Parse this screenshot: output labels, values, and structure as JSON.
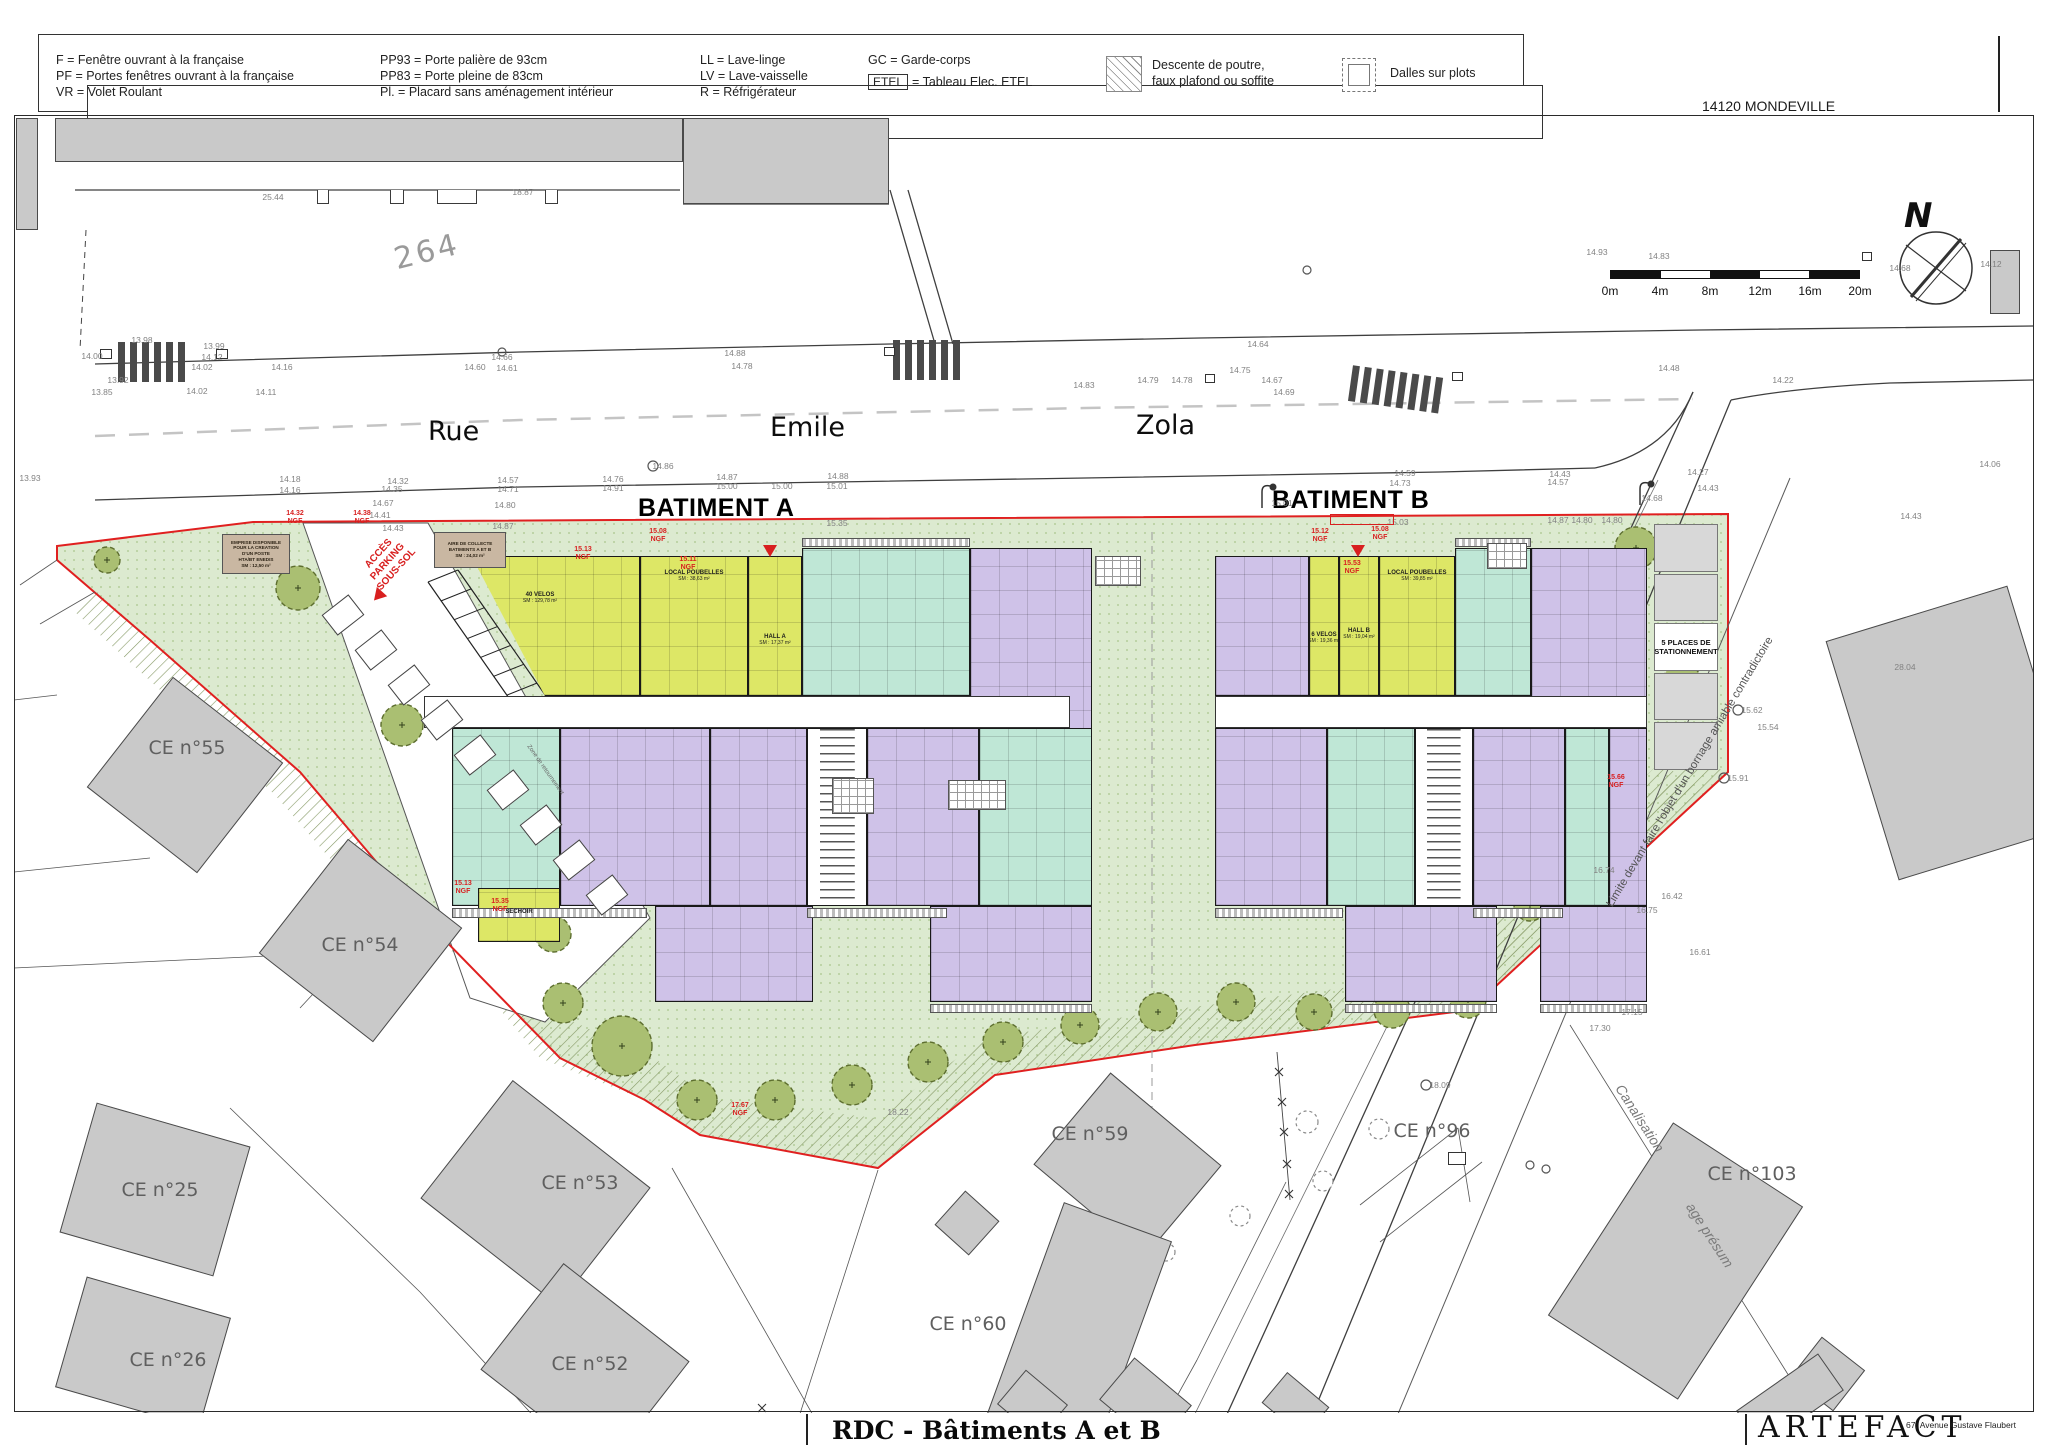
{
  "colors": {
    "green": "#dcead0",
    "green_dot": "#a9c48b",
    "hatch": "#879a66",
    "chartreuse": "#dde766",
    "mint": "#bfe7d6",
    "purple": "#cfc2e8",
    "brown": "#c9b7a2",
    "gray_building": "#c9c9c9",
    "red": "#d81f1f",
    "road_line": "#3f3f3f",
    "blue": "#5b79c9"
  },
  "legend": {
    "col1": [
      "F = Fenêtre ouvrant à la française",
      "PF = Portes fenêtres ouvrant à la française",
      "VR = Volet Roulant"
    ],
    "col2": [
      "PP93 = Porte palière de 93cm",
      "PP83 = Porte pleine de 83cm",
      "Pl. = Placard sans aménagement intérieur"
    ],
    "col3": [
      "LL = Lave-linge",
      "LV = Lave-vaisselle",
      "R = Réfrigérateur"
    ],
    "gc_line": "GC = Garde-corps",
    "etel_box": "ETEL",
    "etel_rest": "= Tableau Elec. ETEL",
    "hatch_line1": "Descente de poutre,",
    "hatch_line2": "faux plafond ou soffite",
    "plots_label": "Dalles sur plots"
  },
  "sheet": {
    "location": "14120 MONDEVILLE",
    "parcel_number": "264",
    "north": "N"
  },
  "scale_bar": {
    "labels": [
      "0m",
      "4m",
      "8m",
      "12m",
      "16m",
      "20m"
    ]
  },
  "streets": [
    {
      "t": "Rue",
      "x": 428,
      "y": 416
    },
    {
      "t": "Emile",
      "x": 770,
      "y": 412
    },
    {
      "t": "Zola",
      "x": 1136,
      "y": 410
    }
  ],
  "buildings": [
    {
      "t": "BATIMENT A",
      "x": 638,
      "y": 494
    },
    {
      "t": "BATIMENT B",
      "x": 1272,
      "y": 486
    }
  ],
  "parcels": [
    {
      "t": "CE n°55",
      "x": 187,
      "y": 748
    },
    {
      "t": "CE n°54",
      "x": 360,
      "y": 945
    },
    {
      "t": "CE n°25",
      "x": 160,
      "y": 1190
    },
    {
      "t": "CE n°26",
      "x": 168,
      "y": 1360
    },
    {
      "t": "CE n°53",
      "x": 580,
      "y": 1183
    },
    {
      "t": "CE n°52",
      "x": 590,
      "y": 1364
    },
    {
      "t": "CE n°59",
      "x": 1090,
      "y": 1134
    },
    {
      "t": "CE n°60",
      "x": 968,
      "y": 1324
    },
    {
      "t": "CE n°96",
      "x": 1432,
      "y": 1131
    },
    {
      "t": "CE n°103",
      "x": 1752,
      "y": 1174
    }
  ],
  "rooms": [
    {
      "t": "40 VELOS",
      "s": "SM : 129,78 m²",
      "x": 540,
      "y": 598
    },
    {
      "t": "LOCAL POUBELLES",
      "s": "SM : 38,63 m²",
      "x": 694,
      "y": 576
    },
    {
      "t": "HALL A",
      "s": "SM : 17,37 m²",
      "x": 775,
      "y": 640
    },
    {
      "t": "6 VELOS",
      "s": "SM : 19,36 m²",
      "x": 1324,
      "y": 638
    },
    {
      "t": "HALL B",
      "s": "SM : 19,04 m²",
      "x": 1359,
      "y": 634
    },
    {
      "t": "LOCAL POUBELLES",
      "s": "SM : 39,85 m²",
      "x": 1417,
      "y": 576
    },
    {
      "t": "SECHOIR",
      "s": "",
      "x": 519,
      "y": 912
    }
  ],
  "annotations": {
    "access": [
      "ACCÈS",
      "PARKING",
      "SOUS-SOL"
    ],
    "limit": "Limite devant faire l'objet d'un bornage amiable contradictoire",
    "canal1": "Canalisation",
    "canal2": "age présum",
    "turnzone": "Zone de retournement",
    "parking5_l1": "5 PLACES DE",
    "parking5_l2": "STATIONNEMENT"
  },
  "brown_boxes": [
    {
      "lines": [
        "EMPRISE DISPONIBLE",
        "POUR LA CREATION",
        "D'UN POSTE",
        "HTA/BT ENEDIS",
        "SM : 12,50 m²"
      ],
      "x": 222,
      "y": 534,
      "w": 68,
      "h": 40
    },
    {
      "lines": [
        "AIRE DE COLLECTE",
        "BATIMENTS A ET B",
        "SM : 24,02 m²"
      ],
      "x": 434,
      "y": 532,
      "w": 72,
      "h": 36
    }
  ],
  "elevations": [
    [
      "13.93",
      30,
      478
    ],
    [
      "14.00",
      92,
      356
    ],
    [
      "13.98",
      142,
      340
    ],
    [
      "13.92",
      118,
      380
    ],
    [
      "13.85",
      102,
      392
    ],
    [
      "14.12",
      212,
      357
    ],
    [
      "13.99",
      214,
      346
    ],
    [
      "14.02",
      202,
      367
    ],
    [
      "14.02",
      197,
      391
    ],
    [
      "14.16",
      282,
      367
    ],
    [
      "14.11",
      266,
      392
    ],
    [
      "14.18",
      290,
      479
    ],
    [
      "14.16",
      290,
      490
    ],
    [
      "14.66",
      502,
      357
    ],
    [
      "14.60",
      475,
      367
    ],
    [
      "14.61",
      507,
      368
    ],
    [
      "25.44",
      273,
      197
    ],
    [
      "18.87",
      523,
      192
    ],
    [
      "14.32",
      398,
      481
    ],
    [
      "14.35",
      392,
      489
    ],
    [
      "14.67",
      383,
      503
    ],
    [
      "14.41",
      380,
      515
    ],
    [
      "14.43",
      393,
      528
    ],
    [
      "14.57",
      508,
      480
    ],
    [
      "14.71",
      508,
      489
    ],
    [
      "14.80",
      505,
      505
    ],
    [
      "14.87",
      503,
      526
    ],
    [
      "14.76",
      613,
      479
    ],
    [
      "14.91",
      613,
      488
    ],
    [
      "14.86",
      663,
      466
    ],
    [
      "14.88",
      735,
      353
    ],
    [
      "14.78",
      742,
      366
    ],
    [
      "14.87",
      727,
      477
    ],
    [
      "15.00",
      727,
      486
    ],
    [
      "15.00",
      782,
      486
    ],
    [
      "14.83",
      1084,
      385
    ],
    [
      "14.79",
      1148,
      380
    ],
    [
      "14.78",
      1182,
      380
    ],
    [
      "14.88",
      838,
      476
    ],
    [
      "15.01",
      837,
      486
    ],
    [
      "15.35",
      837,
      523
    ],
    [
      "14.64",
      1258,
      344
    ],
    [
      "14.75",
      1240,
      370
    ],
    [
      "14.67",
      1272,
      380
    ],
    [
      "14.69",
      1284,
      392
    ],
    [
      "14.93",
      1597,
      252
    ],
    [
      "14.83",
      1659,
      256
    ],
    [
      "14.68",
      1900,
      268
    ],
    [
      "14.12",
      1991,
      264
    ],
    [
      "14.48",
      1669,
      368
    ],
    [
      "14.22",
      1783,
      380
    ],
    [
      "14.06",
      1990,
      464
    ],
    [
      "14.43",
      1911,
      516
    ],
    [
      "14.59",
      1405,
      473
    ],
    [
      "14.73",
      1400,
      483
    ],
    [
      "14.43",
      1560,
      474
    ],
    [
      "14.57",
      1558,
      482
    ],
    [
      "14.27",
      1698,
      472
    ],
    [
      "15.01",
      1282,
      503
    ],
    [
      "15.03",
      1398,
      522
    ],
    [
      "14.87",
      1558,
      520
    ],
    [
      "14.80",
      1582,
      520
    ],
    [
      "14.80",
      1612,
      520
    ],
    [
      "14.68",
      1652,
      498
    ],
    [
      "14.43",
      1708,
      488
    ],
    [
      "15.62",
      1752,
      710
    ],
    [
      "15.91",
      1738,
      778
    ],
    [
      "15.54",
      1768,
      727
    ],
    [
      "16.74",
      1604,
      870
    ],
    [
      "16.75",
      1647,
      910
    ],
    [
      "16.42",
      1672,
      896
    ],
    [
      "16.61",
      1700,
      952
    ],
    [
      "17.15",
      1632,
      1012
    ],
    [
      "17.30",
      1600,
      1028
    ],
    [
      "28.04",
      1905,
      667
    ],
    [
      "18.09",
      1440,
      1085
    ],
    [
      "18.22",
      898,
      1112
    ]
  ],
  "ngf": [
    [
      "14.32",
      295,
      510
    ],
    [
      "14.38",
      362,
      510
    ],
    [
      "15.13",
      583,
      546
    ],
    [
      "15.08",
      658,
      528
    ],
    [
      "15.11",
      688,
      556
    ],
    [
      "15.12",
      1320,
      528
    ],
    [
      "15.08",
      1380,
      526
    ],
    [
      "15.53",
      1352,
      560
    ],
    [
      "15.13",
      463,
      880
    ],
    [
      "15.35",
      500,
      898
    ],
    [
      "17.67",
      740,
      1102
    ],
    [
      "15.66",
      1616,
      774
    ]
  ],
  "titleblock": {
    "title": "RDC - Bâtiments A et B",
    "firm": "ARTEFACT",
    "address": "67, Avenue Gustave Flaubert"
  },
  "floorplan": {
    "units": [
      [
        424,
        556,
        216,
        140,
        "ch",
        "polygon(22% 0,100% 0,100% 100%,56% 100%)"
      ],
      [
        640,
        556,
        108,
        140,
        "ch"
      ],
      [
        748,
        556,
        54,
        140,
        "ch"
      ],
      [
        802,
        548,
        168,
        148,
        "mi"
      ],
      [
        970,
        548,
        122,
        212,
        "pu"
      ],
      [
        424,
        696,
        646,
        32,
        "wh"
      ],
      [
        452,
        728,
        108,
        178,
        "mi"
      ],
      [
        560,
        728,
        150,
        178,
        "pu"
      ],
      [
        710,
        728,
        97,
        178,
        "pu"
      ],
      [
        807,
        728,
        60,
        178,
        "st"
      ],
      [
        867,
        728,
        112,
        178,
        "pu"
      ],
      [
        979,
        728,
        113,
        178,
        "mi"
      ],
      [
        655,
        906,
        158,
        96,
        "pu"
      ],
      [
        930,
        906,
        162,
        96,
        "pu"
      ],
      [
        478,
        888,
        82,
        54,
        "ch"
      ],
      [
        1215,
        556,
        94,
        140,
        "pu"
      ],
      [
        1309,
        556,
        30,
        140,
        "ch"
      ],
      [
        1339,
        556,
        40,
        140,
        "ch"
      ],
      [
        1379,
        556,
        76,
        140,
        "ch"
      ],
      [
        1455,
        548,
        76,
        148,
        "mi"
      ],
      [
        1531,
        548,
        116,
        212,
        "pu"
      ],
      [
        1215,
        696,
        432,
        32,
        "wh"
      ],
      [
        1215,
        728,
        112,
        178,
        "pu"
      ],
      [
        1327,
        728,
        88,
        178,
        "mi"
      ],
      [
        1415,
        728,
        58,
        178,
        "st"
      ],
      [
        1473,
        728,
        92,
        178,
        "pu"
      ],
      [
        1565,
        728,
        44,
        178,
        "mi"
      ],
      [
        1609,
        728,
        38,
        178,
        "pu"
      ],
      [
        1345,
        906,
        152,
        96,
        "pu"
      ],
      [
        1540,
        906,
        107,
        96,
        "pu"
      ]
    ],
    "balconies": [
      [
        452,
        908,
        195,
        10
      ],
      [
        807,
        908,
        140,
        10
      ],
      [
        1215,
        908,
        128,
        10
      ],
      [
        1473,
        908,
        90,
        10
      ],
      [
        802,
        538,
        168,
        9
      ],
      [
        1455,
        538,
        76,
        9
      ],
      [
        930,
        1004,
        162,
        9
      ],
      [
        1345,
        1004,
        152,
        9
      ],
      [
        1540,
        1004,
        107,
        9
      ]
    ],
    "pergolas": [
      [
        832,
        778,
        42,
        36
      ],
      [
        948,
        780,
        58,
        30
      ],
      [
        1487,
        543,
        40,
        26
      ],
      [
        1095,
        556,
        46,
        30
      ]
    ],
    "stalls": {
      "x0": 330,
      "y0": 598,
      "dx": 33,
      "dy": 35,
      "n": 9,
      "w": 26,
      "h": 34,
      "rot": 52
    },
    "pstalls": {
      "x": 1654,
      "y": 524,
      "w": 64,
      "h": 248,
      "n": 5,
      "label_cell": 2
    },
    "gray_buildings": [
      [
        16,
        118,
        22,
        112,
        0
      ],
      [
        55,
        118,
        628,
        44,
        0
      ],
      [
        683,
        118,
        206,
        86,
        0
      ],
      [
        1990,
        250,
        30,
        64,
        0
      ],
      [
        115,
        705,
        140,
        140,
        38
      ],
      [
        288,
        868,
        145,
        145,
        38
      ],
      [
        75,
        1122,
        160,
        135,
        16
      ],
      [
        68,
        1295,
        150,
        115,
        16
      ],
      [
        448,
        1118,
        175,
        150,
        38
      ],
      [
        505,
        1298,
        160,
        135,
        38
      ],
      [
        1055,
        1105,
        145,
        120,
        40
      ],
      [
        1022,
        1215,
        115,
        225,
        20
      ],
      [
        944,
        1200,
        46,
        46,
        42
      ],
      [
        1598,
        1146,
        155,
        230,
        33
      ],
      [
        1800,
        1348,
        55,
        52,
        38
      ],
      [
        1858,
        608,
        190,
        250,
        -17
      ],
      [
        1005,
        1382,
        55,
        45,
        40
      ],
      [
        1108,
        1375,
        75,
        55,
        40
      ],
      [
        1268,
        1385,
        55,
        40,
        40
      ],
      [
        1740,
        1378,
        100,
        45,
        -35
      ]
    ],
    "teeth": [
      [
        317,
        190,
        12,
        14
      ],
      [
        390,
        190,
        14,
        14
      ],
      [
        437,
        190,
        40,
        14
      ],
      [
        545,
        190,
        13,
        14
      ]
    ],
    "crosswalks": [
      [
        118,
        342,
        78,
        40,
        0
      ],
      [
        893,
        340,
        74,
        40,
        0
      ],
      [
        1350,
        372,
        100,
        36,
        8
      ]
    ],
    "trees": [
      [
        697,
        1100,
        20
      ],
      [
        775,
        1100,
        20
      ],
      [
        852,
        1085,
        20
      ],
      [
        928,
        1062,
        20
      ],
      [
        1003,
        1042,
        20
      ],
      [
        1080,
        1025,
        19
      ],
      [
        1158,
        1012,
        19
      ],
      [
        1236,
        1002,
        19
      ],
      [
        1314,
        1012,
        18
      ],
      [
        1392,
        1010,
        18
      ],
      [
        1468,
        1000,
        18
      ],
      [
        1530,
        905,
        16
      ],
      [
        1576,
        866,
        15
      ],
      [
        1608,
        807,
        17
      ],
      [
        1682,
        682,
        19
      ],
      [
        1636,
        548,
        21
      ],
      [
        622,
        1046,
        30
      ],
      [
        563,
        1003,
        20
      ],
      [
        553,
        934,
        18
      ],
      [
        486,
        834,
        21
      ],
      [
        402,
        725,
        21
      ],
      [
        298,
        588,
        22
      ],
      [
        107,
        560,
        13
      ]
    ],
    "bushes": [
      [
        1307,
        1122,
        11
      ],
      [
        1379,
        1129,
        10
      ],
      [
        1323,
        1181,
        10
      ],
      [
        1240,
        1216,
        10
      ],
      [
        1166,
        1252,
        9
      ],
      [
        1100,
        1296,
        9
      ],
      [
        1035,
        1332,
        9
      ]
    ],
    "uboxes": [
      [
        100,
        349,
        12,
        10
      ],
      [
        216,
        349,
        12,
        10
      ],
      [
        884,
        347,
        11,
        9
      ],
      [
        1452,
        372,
        11,
        9
      ],
      [
        1205,
        374,
        10,
        9
      ],
      [
        1862,
        252,
        10,
        9
      ],
      [
        1448,
        1152,
        18,
        13
      ]
    ],
    "ucircles": [
      [
        653,
        466,
        5
      ],
      [
        1738,
        710,
        5
      ],
      [
        1724,
        778,
        5
      ],
      [
        1633,
        910,
        5
      ],
      [
        1426,
        1085,
        5
      ],
      [
        1530,
        1165,
        4
      ],
      [
        1546,
        1169,
        4
      ],
      [
        502,
        352,
        4
      ],
      [
        1307,
        270,
        4
      ]
    ],
    "red_triangles": [
      [
        770,
        545,
        0
      ],
      [
        1358,
        545,
        0
      ],
      [
        378,
        590,
        42
      ]
    ],
    "red_boxes": [
      [
        1330,
        514,
        64,
        11
      ]
    ]
  }
}
